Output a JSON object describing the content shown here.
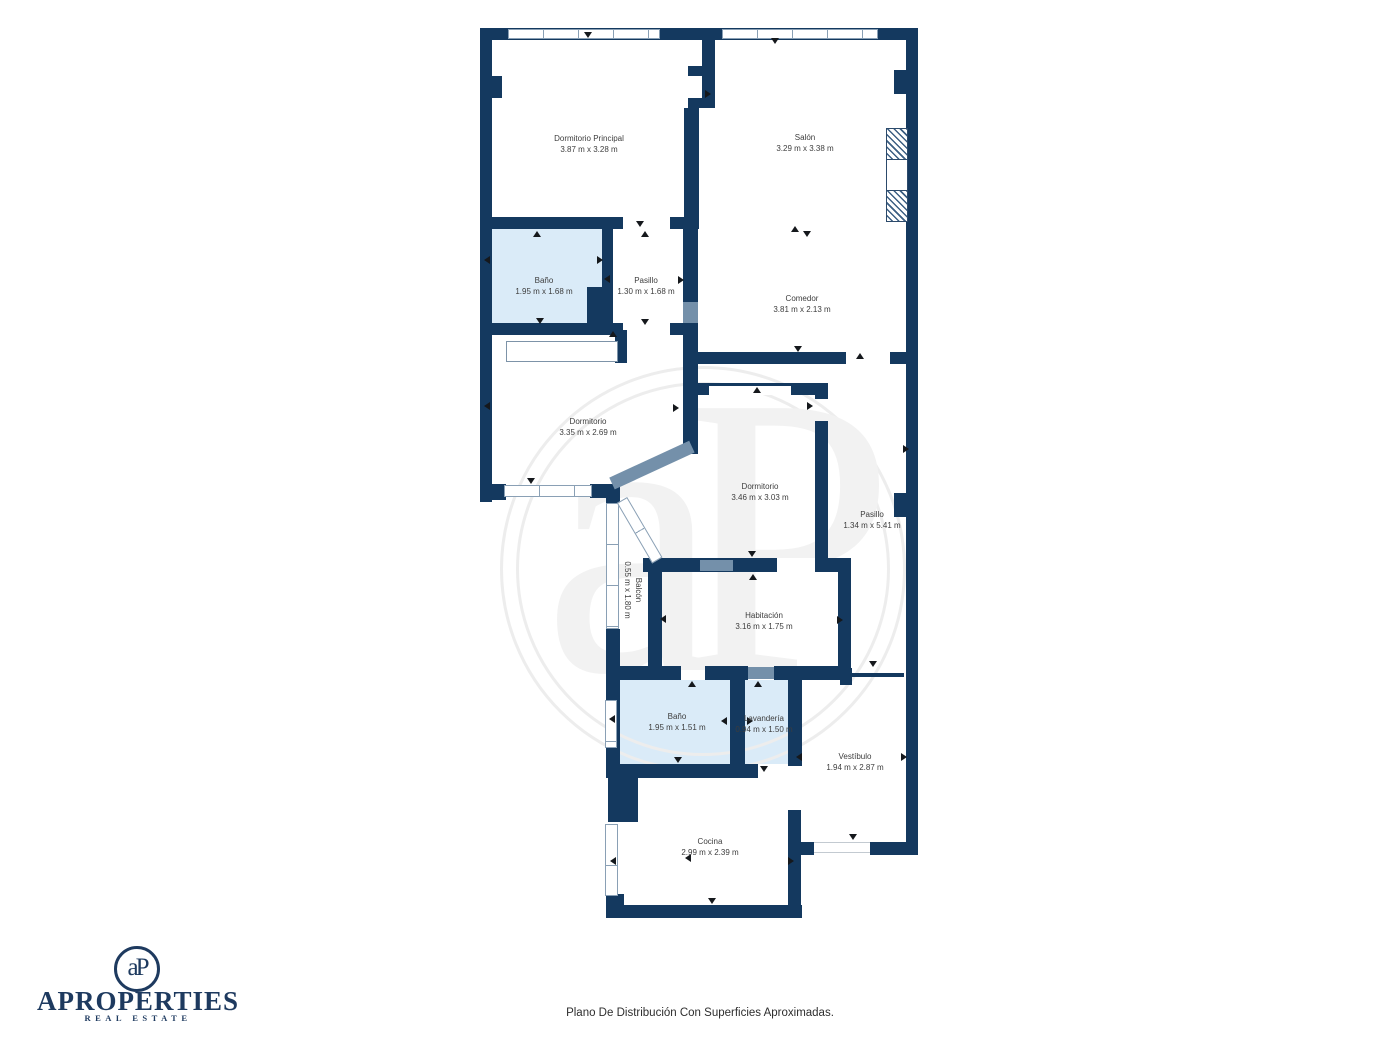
{
  "page": {
    "caption": "Plano De Distribución Con Superficies Aproximadas."
  },
  "brand": {
    "name": "APROPERTIES",
    "tagline": "REAL ESTATE",
    "monogram": "aP"
  },
  "watermark": {
    "monogram": "aP"
  },
  "rooms": [
    {
      "name": "Dormitorio Principal",
      "dims": "3.87 m x 3.28 m"
    },
    {
      "name": "Salón",
      "dims": "3.29 m x 3.38 m"
    },
    {
      "name": "Baño",
      "dims": "1.95 m x 1.68 m"
    },
    {
      "name": "Pasillo",
      "dims": "1.30 m x 1.68 m"
    },
    {
      "name": "Comedor",
      "dims": "3.81 m x 2.13 m"
    },
    {
      "name": "Dormitorio",
      "dims": "3.35 m x 2.69 m"
    },
    {
      "name": "Dormitorio",
      "dims": "3.46 m x 3.03 m"
    },
    {
      "name": "Pasillo",
      "dims": "1.34 m x 5.41 m"
    },
    {
      "name": "Balcón",
      "dims": "0.55 m x 1.80 m"
    },
    {
      "name": "Habitación",
      "dims": "3.16 m x 1.75 m"
    },
    {
      "name": "Baño",
      "dims": "1.95 m x 1.51 m"
    },
    {
      "name": "Lavandería",
      "dims": "0.94 m x 1.50 m"
    },
    {
      "name": "Vestíbulo",
      "dims": "1.94 m x 2.87 m"
    },
    {
      "name": "Cocina",
      "dims": "2.99 m x 2.39 m"
    }
  ],
  "colors": {
    "wall": "#14395f",
    "wall_light": "#7490aa",
    "bath_fill": "#daebf8",
    "window_border": "#8aa0b5",
    "label_text": "#3d3d3d",
    "brand_navy": "#1e3a5f",
    "watermark": "#f2f2f2"
  },
  "markers": {
    "door_marker": "small solid triangle indicating openings/doors"
  }
}
